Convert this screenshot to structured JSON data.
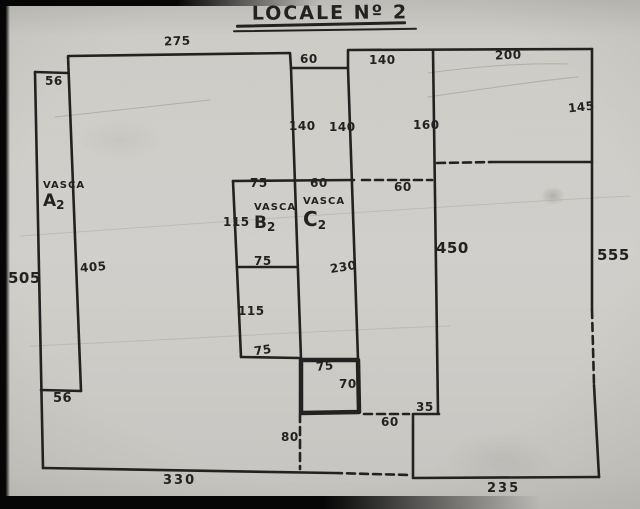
{
  "title": {
    "text": "LOCALE Nº 2"
  },
  "rooms": {
    "a": {
      "name": "VASCA",
      "letter": "A",
      "number": "2"
    },
    "b": {
      "name": "VASCA",
      "letter": "B",
      "number": "2"
    },
    "c": {
      "name": "VASCA",
      "letter": "C",
      "number": "2"
    }
  },
  "dims": {
    "top_width": "275",
    "top_left_56": "56",
    "notch_60": "60",
    "top_room_140": "140",
    "top_right_200": "200",
    "col_140_left": "140",
    "col_140_right": "140",
    "room_160": "160",
    "right_145": "145",
    "a2_height_405": "405",
    "left_height_505": "505",
    "b2_top_75": "75",
    "c2_top_60": "60",
    "b2_left_115": "115",
    "b2_bottom_75": "75",
    "c2_height_230": "230",
    "lower_box_115": "115",
    "lower_box_75": "75",
    "opening_60_mid": "60",
    "wall_450": "450",
    "right_height_555": "555",
    "small_box_75": "75",
    "small_box_70": "70",
    "step_35": "35",
    "opening_60_bottom": "60",
    "opening_80": "80",
    "a2_bottom_56": "56",
    "bottom_330": "330",
    "bottom_235": "235"
  },
  "colors": {
    "ink": "#232220",
    "paper": "#c8c6c1",
    "photo_border": "#060606"
  }
}
